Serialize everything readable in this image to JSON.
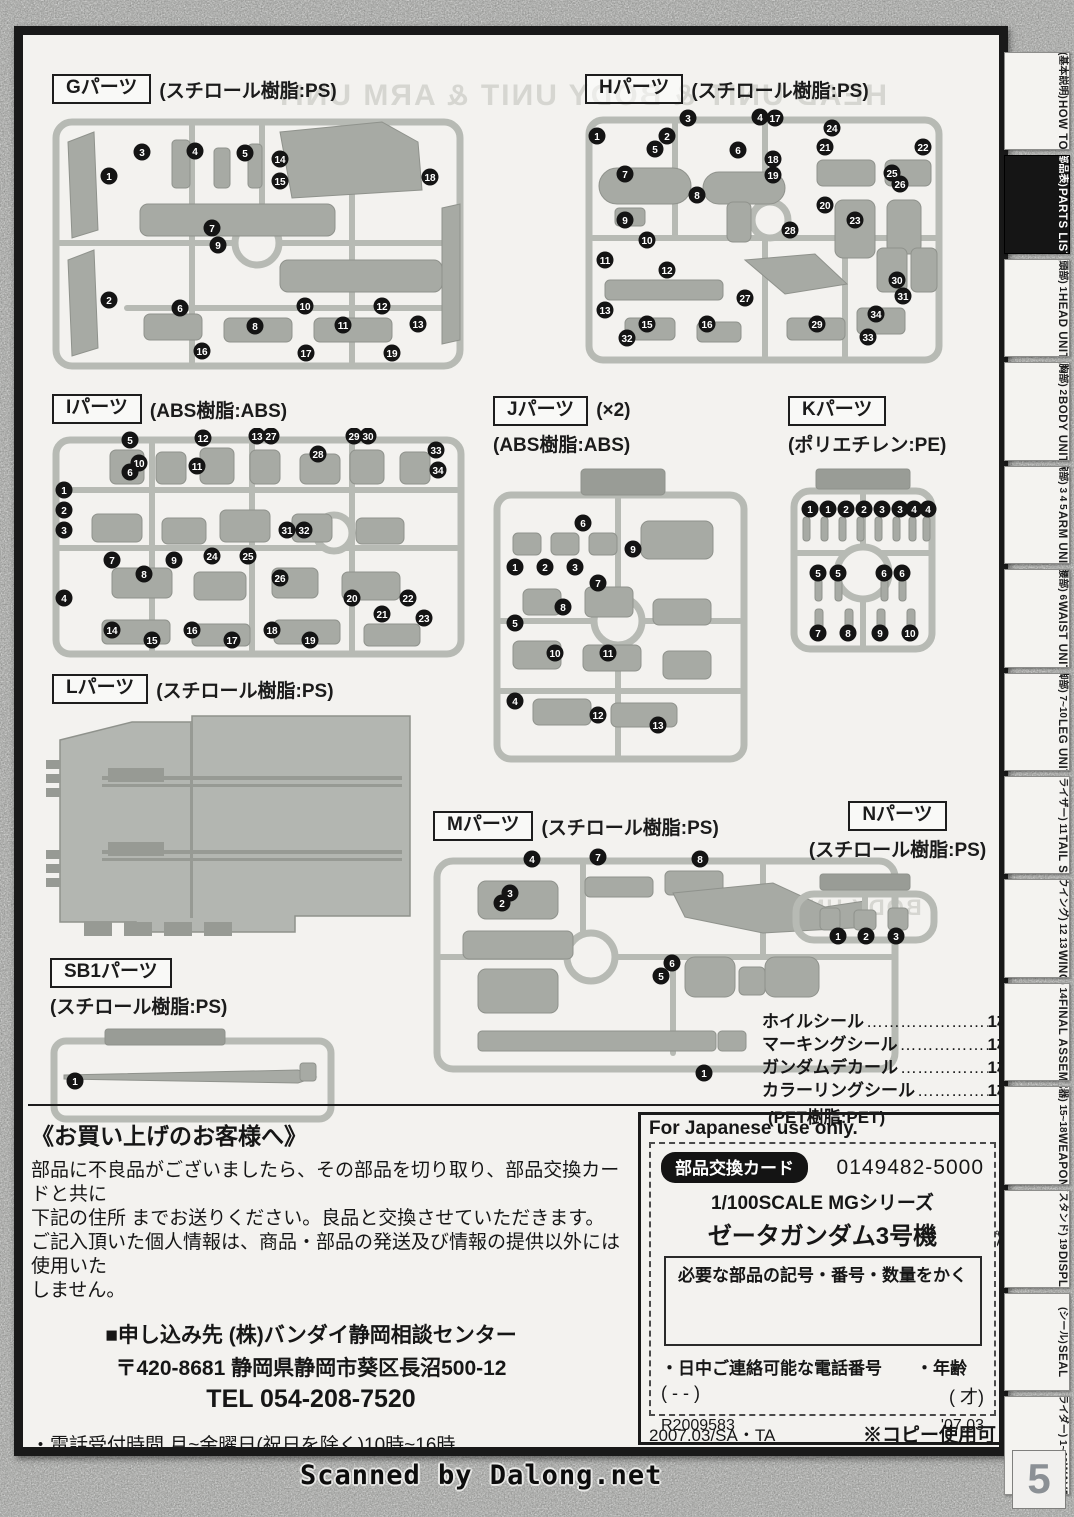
{
  "document": {
    "bleed_text": "HEAD UNIT & BODY UNIT & ARM UNIT",
    "bleed_text2": "BODY UNIT",
    "watermark": "Scanned by Dalong.net",
    "page_number": "5"
  },
  "sprues": [
    {
      "id": "G",
      "label": "Gパーツ",
      "note": "",
      "material": "(スチロール樹脂:PS)",
      "layout": "inline",
      "callouts": [
        [
          1,
          57,
          68
        ],
        [
          3,
          90,
          44
        ],
        [
          4,
          143,
          43
        ],
        [
          5,
          193,
          45
        ],
        [
          14,
          228,
          51
        ],
        [
          15,
          228,
          73
        ],
        [
          18,
          378,
          69
        ],
        [
          7,
          160,
          120
        ],
        [
          9,
          166,
          137
        ],
        [
          2,
          57,
          192
        ],
        [
          6,
          128,
          200
        ],
        [
          8,
          203,
          218
        ],
        [
          10,
          253,
          198
        ],
        [
          11,
          291,
          217
        ],
        [
          12,
          330,
          198
        ],
        [
          13,
          366,
          216
        ],
        [
          16,
          150,
          243
        ],
        [
          17,
          254,
          245
        ],
        [
          19,
          340,
          245
        ]
      ]
    },
    {
      "id": "H",
      "label": "Hパーツ",
      "note": "",
      "material": "(スチロール樹脂:PS)",
      "layout": "inline",
      "callouts": [
        [
          1,
          12,
          28
        ],
        [
          2,
          82,
          28
        ],
        [
          3,
          103,
          10
        ],
        [
          4,
          175,
          9
        ],
        [
          17,
          190,
          10
        ],
        [
          5,
          70,
          41
        ],
        [
          6,
          153,
          42
        ],
        [
          18,
          188,
          51
        ],
        [
          19,
          188,
          67
        ],
        [
          8,
          112,
          87
        ],
        [
          21,
          240,
          39
        ],
        [
          22,
          338,
          39
        ],
        [
          24,
          247,
          20
        ],
        [
          25,
          307,
          65
        ],
        [
          26,
          315,
          76
        ],
        [
          20,
          240,
          97
        ],
        [
          23,
          270,
          112
        ],
        [
          7,
          40,
          66
        ],
        [
          9,
          40,
          112
        ],
        [
          10,
          62,
          132
        ],
        [
          11,
          20,
          152
        ],
        [
          12,
          82,
          162
        ],
        [
          27,
          160,
          190
        ],
        [
          28,
          205,
          122
        ],
        [
          13,
          20,
          202
        ],
        [
          15,
          62,
          216
        ],
        [
          16,
          122,
          216
        ],
        [
          29,
          232,
          216
        ],
        [
          30,
          312,
          172
        ],
        [
          31,
          318,
          188
        ],
        [
          32,
          42,
          230
        ],
        [
          33,
          283,
          229
        ],
        [
          34,
          291,
          206
        ]
      ]
    },
    {
      "id": "I",
      "label": "Iパーツ",
      "note": "",
      "material": "(ABS樹脂:ABS)",
      "layout": "inline",
      "callouts": [
        [
          5,
          78,
          12
        ],
        [
          12,
          151,
          10
        ],
        [
          13,
          205,
          8
        ],
        [
          27,
          219,
          8
        ],
        [
          29,
          302,
          8
        ],
        [
          30,
          316,
          8
        ],
        [
          10,
          87,
          35
        ],
        [
          6,
          78,
          44
        ],
        [
          11,
          145,
          38
        ],
        [
          28,
          266,
          26
        ],
        [
          33,
          384,
          22
        ],
        [
          34,
          386,
          42
        ],
        [
          1,
          12,
          62
        ],
        [
          2,
          12,
          82
        ],
        [
          3,
          12,
          102
        ],
        [
          31,
          235,
          102
        ],
        [
          32,
          252,
          102
        ],
        [
          24,
          160,
          128
        ],
        [
          25,
          196,
          128
        ],
        [
          26,
          228,
          150
        ],
        [
          4,
          12,
          170
        ],
        [
          7,
          60,
          132
        ],
        [
          8,
          92,
          146
        ],
        [
          9,
          122,
          132
        ],
        [
          20,
          300,
          170
        ],
        [
          21,
          330,
          186
        ],
        [
          22,
          356,
          170
        ],
        [
          23,
          372,
          190
        ],
        [
          14,
          60,
          202
        ],
        [
          15,
          100,
          212
        ],
        [
          16,
          140,
          202
        ],
        [
          17,
          180,
          212
        ],
        [
          18,
          220,
          202
        ],
        [
          19,
          258,
          212
        ]
      ]
    },
    {
      "id": "J",
      "label": "Jパーツ",
      "note": "(×2)",
      "material": "(ABS樹脂:ABS)",
      "layout": "stacked",
      "callouts": [
        [
          6,
          90,
          62
        ],
        [
          1,
          22,
          106
        ],
        [
          2,
          52,
          106
        ],
        [
          3,
          82,
          106
        ],
        [
          9,
          140,
          88
        ],
        [
          7,
          105,
          122
        ],
        [
          8,
          70,
          146
        ],
        [
          5,
          22,
          162
        ],
        [
          10,
          62,
          192
        ],
        [
          11,
          115,
          192
        ],
        [
          4,
          22,
          240
        ],
        [
          12,
          105,
          254
        ],
        [
          13,
          165,
          264
        ]
      ]
    },
    {
      "id": "K",
      "label": "Kパーツ",
      "note": "",
      "material": "(ポリエチレン:PE)",
      "layout": "stacked",
      "callouts": [
        [
          1,
          22,
          48
        ],
        [
          1,
          40,
          48
        ],
        [
          2,
          58,
          48
        ],
        [
          2,
          76,
          48
        ],
        [
          3,
          94,
          48
        ],
        [
          3,
          112,
          48
        ],
        [
          4,
          126,
          48
        ],
        [
          4,
          140,
          48
        ],
        [
          5,
          30,
          112
        ],
        [
          5,
          50,
          112
        ],
        [
          6,
          96,
          112
        ],
        [
          6,
          114,
          112
        ],
        [
          7,
          30,
          172
        ],
        [
          8,
          60,
          172
        ],
        [
          9,
          92,
          172
        ],
        [
          10,
          122,
          172
        ]
      ]
    },
    {
      "id": "L",
      "label": "Lパーツ",
      "note": "",
      "material": "(スチロール樹脂:PS)",
      "layout": "inline",
      "callouts": []
    },
    {
      "id": "M",
      "label": "Mパーツ",
      "note": "",
      "material": "(スチロール樹脂:PS)",
      "layout": "inline",
      "callouts": [
        [
          4,
          99,
          14
        ],
        [
          7,
          165,
          12
        ],
        [
          8,
          267,
          14
        ],
        [
          3,
          77,
          48
        ],
        [
          2,
          69,
          58
        ],
        [
          6,
          239,
          118
        ],
        [
          5,
          228,
          131
        ],
        [
          1,
          271,
          228
        ]
      ]
    },
    {
      "id": "N",
      "label": "Nパーツ",
      "note": "",
      "material": "(スチロール樹脂:PS)",
      "layout": "stacked",
      "callouts": [
        [
          1,
          48,
          70
        ],
        [
          2,
          76,
          70
        ],
        [
          3,
          106,
          70
        ]
      ]
    },
    {
      "id": "SB1",
      "label": "SB1パーツ",
      "note": "",
      "material": "(スチロール樹脂:PS)",
      "layout": "stacked",
      "callouts": [
        [
          1,
          25,
          58
        ]
      ]
    }
  ],
  "seals": {
    "items": [
      {
        "name": "ホイルシール",
        "leader": "……………………",
        "count": "1枚"
      },
      {
        "name": "マーキングシール",
        "leader": "…………………",
        "count": "1枚"
      },
      {
        "name": "ガンダムデカール",
        "leader": "…………………",
        "count": "1枚"
      },
      {
        "name": "カラーリングシール",
        "leader": "………………",
        "count": "1枚"
      }
    ],
    "note": "(PET樹脂:PET)"
  },
  "notice": {
    "heading": "《お買い上げのお客様へ》",
    "body1": "部品に不良品がございましたら、その部品を切り取り、部品交換カードと共に",
    "body2": "下記の住所 までお送りください。良品と交換させていただきます。",
    "body3": "ご記入頂いた個人情報は、商品・部品の発送及び情報の提供以外には使用いた",
    "body4": "しません。",
    "address1": "■申し込み先 (株)バンダイ静岡相談センター",
    "address2": "〒420-8681 静岡県静岡市葵区長沼500-12",
    "address3": "TEL 054-208-7520",
    "note1": "・電話受付時間 月~金曜日(祝日を除く)10時~16時",
    "note2": "・電話番号はよく確かめてお間違いのないようにご注意ください。"
  },
  "card": {
    "header": "For Japanese use only.",
    "badge": "部品交換カード",
    "code": "0149482-5000",
    "series": "1/100SCALE MGシリーズ",
    "model": "ゼータガンダム3号機",
    "write_in": "必要な部品の記号・番号・数量をかく",
    "phone_label": "・日中ご連絡可能な電話番号",
    "age_label": "・年齢",
    "phone_blanks": "(  -  -  )",
    "age_blanks": "(  才)",
    "ref": "R2009583",
    "date": "'07.03",
    "footer_left": "2007.03/SA・TA",
    "footer_right": "※コピー使用可",
    "scissors_icon": "✂"
  },
  "sidebar": {
    "tabs": [
      {
        "jp": "(基本説明)",
        "en": "HOW TO",
        "active": false
      },
      {
        "jp": "(部品表)",
        "en": "PARTS LIST",
        "active": true
      },
      {
        "jp": "(頭部) 1",
        "en": "HEAD UNIT",
        "active": false
      },
      {
        "jp": "(胸部) 2",
        "en": "BODY UNIT",
        "active": false
      },
      {
        "jp": "(腕部) 3 4 5",
        "en": "ARM UNIT",
        "active": false
      },
      {
        "jp": "(腰部) 6",
        "en": "WAIST UNIT",
        "active": false
      },
      {
        "jp": "(脚部) 7~10",
        "en": "LEG UNIT",
        "active": false
      },
      {
        "jp": "(テールスタビライザー) 11",
        "en": "TAIL STABILIZER",
        "active": false
      },
      {
        "jp": "(ウイング) 12 13",
        "en": "WING",
        "active": false
      },
      {
        "jp": "(完成) 14",
        "en": "FINAL ASSEMBLE",
        "active": false
      },
      {
        "jp": "(武器) 15~18",
        "en": "WEAPONS",
        "active": false
      },
      {
        "jp": "(ディスプレイスタンド) 19",
        "en": "DISPLAY STAND",
        "active": false
      },
      {
        "jp": "(シール)",
        "en": "SEAL",
        "active": false
      },
      {
        "jp": "(ウェイブライダー) 1~10",
        "en": "WAVE RIDER",
        "active": false
      }
    ]
  }
}
